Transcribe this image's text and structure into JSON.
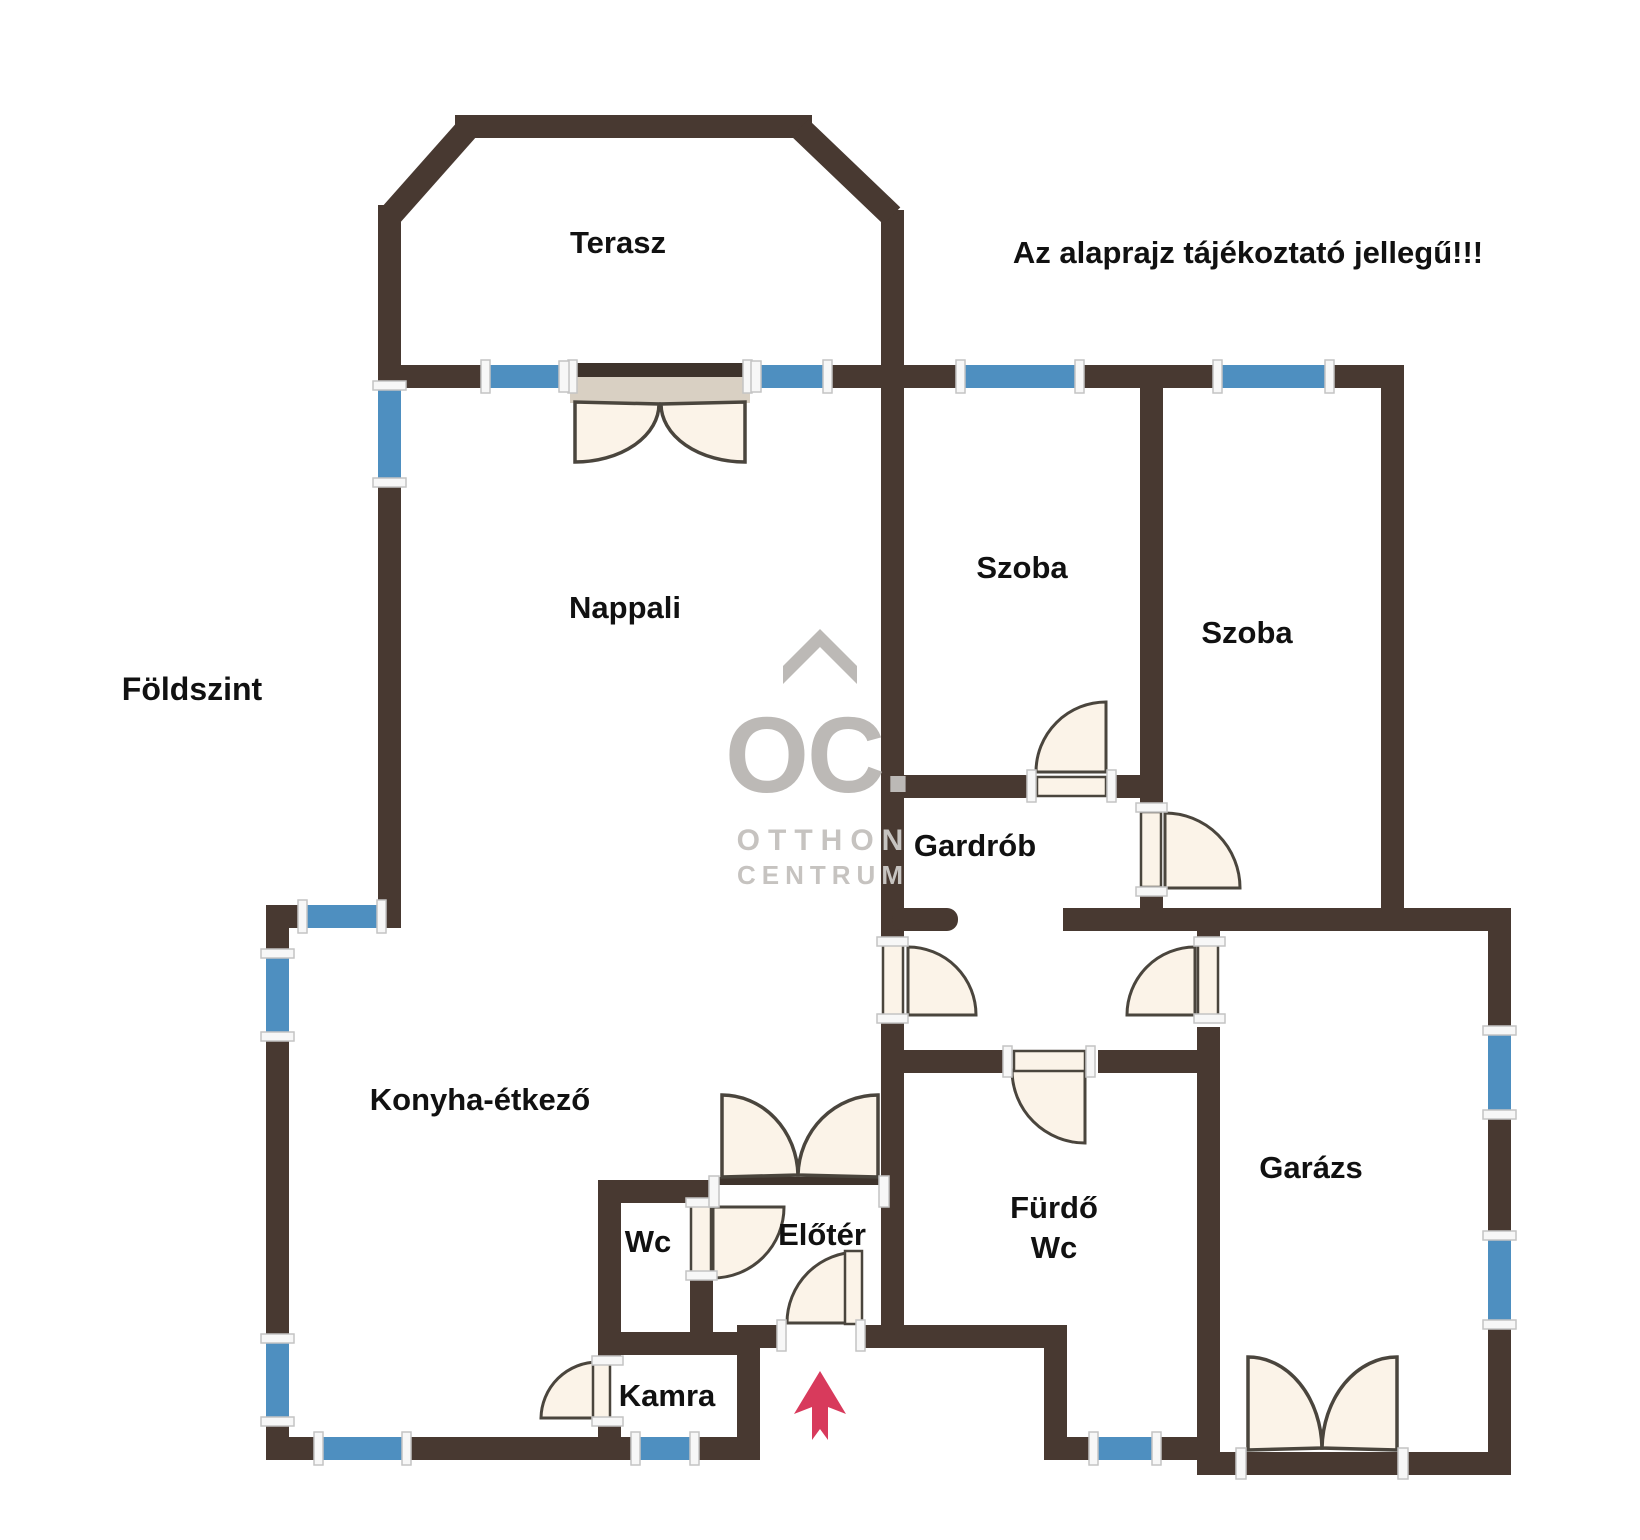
{
  "page": {
    "background": "#ffffff",
    "floor_label": "Földszint",
    "disclaimer": "Az alaprajz tájékoztató jellegű!!!"
  },
  "rooms": {
    "terasz": "Terasz",
    "nappali": "Nappali",
    "szoba1": "Szoba",
    "szoba2": "Szoba",
    "gardrob": "Gardrób",
    "konyha": "Konyha-étkező",
    "wc": "Wc",
    "eloter": "Előtér",
    "furdo_line1": "Fürdő",
    "furdo_line2": "Wc",
    "kamra": "Kamra",
    "garazs": "Garázs"
  },
  "watermark": {
    "monogram": "OC.",
    "line1": "OTTHON",
    "line2": "CENTRUM"
  },
  "icons": {
    "entrance_arrow": "up-arrow"
  },
  "colors": {
    "wall": "#483931",
    "window": "#4E8FC0",
    "window_cap_fill": "#f7f7f7",
    "window_cap_stroke": "#c4c4c4",
    "door_fill": "#FBF3E8",
    "door_stroke": "#4A453D",
    "door_header_dark": "#3E332C",
    "door_header_band": "#D9D0C3",
    "watermark_strong": "#BCB9B6",
    "watermark_soft": "#C6C3C0",
    "arrow": "#D83A5C",
    "text": "#111111"
  }
}
